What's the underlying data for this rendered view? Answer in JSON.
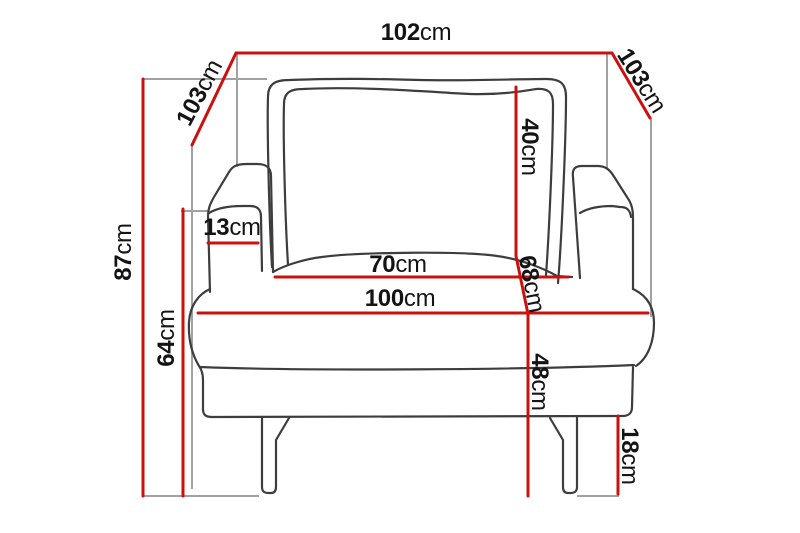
{
  "diagram": {
    "subject": "armchair front-view dimension drawing",
    "unit": "cm",
    "colors": {
      "dimension_line": "#cc100e",
      "outline": "#3d3d3d",
      "extension_line": "#a1a1a1",
      "text": "#141414",
      "background": "#ffffff"
    },
    "measurements": {
      "top_width": {
        "value": "102",
        "unit": "cm"
      },
      "depth_left": {
        "value": "103",
        "unit": "cm"
      },
      "depth_right": {
        "value": "103",
        "unit": "cm"
      },
      "total_height": {
        "value": "87",
        "unit": "cm"
      },
      "armrest_height": {
        "value": "64",
        "unit": "cm"
      },
      "armrest_width": {
        "value": "13",
        "unit": "cm"
      },
      "backrest_height": {
        "value": "40",
        "unit": "cm"
      },
      "seat_depth": {
        "value": "68",
        "unit": "cm"
      },
      "seat_width": {
        "value": "70",
        "unit": "cm"
      },
      "front_width": {
        "value": "100",
        "unit": "cm"
      },
      "seat_height": {
        "value": "48",
        "unit": "cm"
      },
      "leg_height": {
        "value": "18",
        "unit": "cm"
      }
    }
  }
}
